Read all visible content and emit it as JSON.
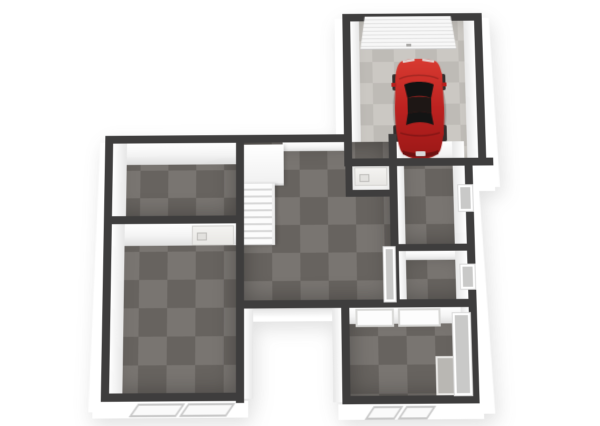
{
  "scene": {
    "type": "3d-floorplan-top-down-view",
    "background": "#ffffff",
    "footprint": "L-shaped house with detached-look garage wing at top right and open notch at bottom center"
  },
  "palette": {
    "wall_top": "#3e3d3d",
    "wall_face_white": "#f4f4f4",
    "carpet_base": "#6f6a66",
    "carpet_tile_alt": "#787370",
    "garage_concrete": "#c8c5c0",
    "car_red": "#c4221f",
    "glass_gray": "#c9c9c8"
  },
  "rooms": [
    {
      "id": "garage",
      "floor": "concrete",
      "features": [
        "ribbed-garage-door-north",
        "red-sports-car"
      ]
    },
    {
      "id": "room-top-left",
      "floor": "carpet-tiles"
    },
    {
      "id": "room-bottom-left",
      "floor": "carpet-tiles",
      "features": [
        "interior-door-north-wall",
        "south-window"
      ]
    },
    {
      "id": "room-central",
      "floor": "carpet-tiles",
      "features": [
        "staircase-with-landing",
        "garage-entry-closet",
        "glass-panel-east-wall"
      ]
    },
    {
      "id": "room-right-upper",
      "floor": "carpet-tiles",
      "features": [
        "east-wall-window"
      ]
    },
    {
      "id": "room-right-lower",
      "floor": "carpet-tiles",
      "features": [
        "east-wall-window"
      ]
    },
    {
      "id": "room-bottom-right",
      "floor": "carpet-tiles",
      "features": [
        "two-north-wall-windows",
        "south-window",
        "east-glass-panel",
        "floor-mat"
      ]
    }
  ],
  "objects": {
    "car": {
      "type": "sports-car-top-view",
      "color": "#c4221f",
      "orientation": "nose-toward-garage-door",
      "location": "garage"
    },
    "staircase": {
      "treads": 9,
      "landing": true,
      "location": "room-central-northwest"
    },
    "garage_door": {
      "style": "sectional-ribbed",
      "wall": "north"
    }
  }
}
